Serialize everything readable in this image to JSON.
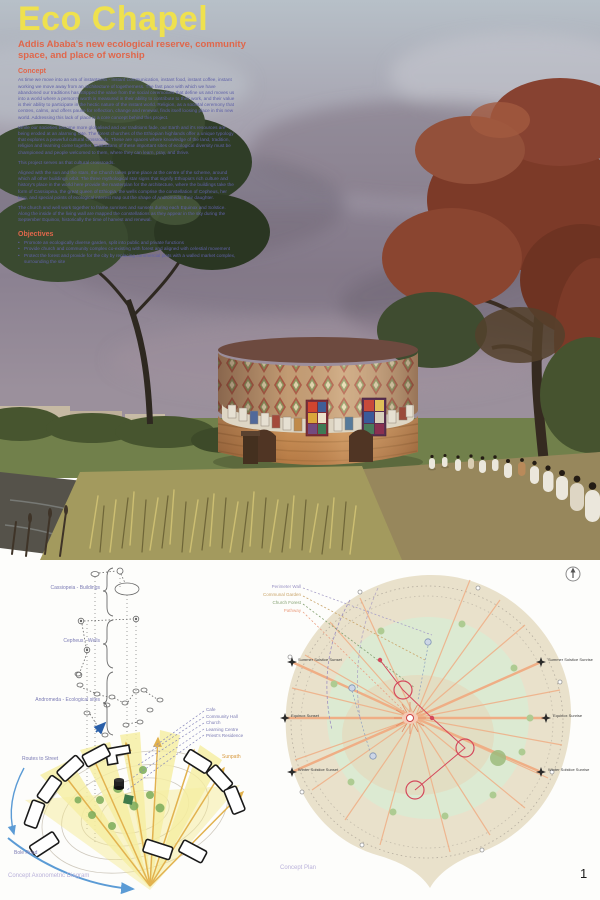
{
  "header": {
    "title": "Eco Chapel",
    "subtitle_lines": [
      "Addis Ababa's new ecological reserve, community",
      "space, and place of worship"
    ]
  },
  "concept": {
    "heading": "Concept",
    "paragraphs": [
      "As time we move into an era of instantness - instant communication, instant food, instant coffee, instant working we move away from an architecture of togetherness. The fast pace with which we have abandoned our traditions has stripped the value from the social ceremonies that define us and moves us into a world where a person's worth is measured in their ability to contribute to their work, and their value is their ability to participate in the hectic nature of the instant world. Religion, as a societal ceremony that centres, calms, and offers pause for reflection, change and renewal, finds itself loosing place in this new world. Addressing this lack of place is a core concept behind this project.",
      "While our societies become more globalised and our traditions fade, our Earth and it's resources are being eroded at an alarming rate. The forest churches of the Ethiopian highlands offer a unique typology that explores a powerful cultural crossroads. These are spaces where knowledge of the land, tradition, religion and learning come together. Custodians of these important sites of ecological diversity must be championed and people welcomed to them, where they can learn, pray, and thrive.",
      "This project serves as that cultural crossroads.",
      "Aligned with the sun and the stars, the Church takes prime place at the centre of the scheme, around which all other buildings orbit. The three mythological star signs that signify Ethiopia's rich culture and history's place in the world here provide the masterplan for the architecture, where the buildings take the form of Cassiopeia, the great queen of Ethiopia, the wells comprise the constellation of Cepheus, her king, and special points of ecological interest map out the shape of Andromeda, their daughter.",
      "The church and well work together to frame sunrises and sunsets during each Equinox and Solstice. Along the inside of the living wall are mapped the constellations as they appear in the sky during the September Equinox, historically the time of harvest and renewal."
    ]
  },
  "objectives": {
    "heading": "Objectives",
    "items": [
      "Promote an ecologically diverse garden, split into public and private functions",
      "Provide church and community complex co-existing with forest and aligned with celestial movement",
      "Protect the forest and provide for the city by replacing commercial plots with a walled market complex, surrounding the site"
    ]
  },
  "axon": {
    "caption": "Concept Axonometric Diagram",
    "group_labels": [
      "Cassiopeia - Buildings",
      "Cepheus - Wells",
      "Andromeda - Ecological sites"
    ],
    "route_label": "Routes to Street",
    "road_label": "Bole Road",
    "sunpath_label": "Sunpath",
    "building_labels": [
      "Cafe",
      "Community Hall",
      "Church",
      "Learning Centre",
      "Priest's Residence"
    ]
  },
  "plan": {
    "caption": "Concept Plan",
    "legend": [
      "Perimeter Wall",
      "Communal Garden",
      "Church Forest",
      "Pathway"
    ],
    "markers_left": [
      "Summer Solstice Sunset",
      "Equinox Sunset",
      "Winter Solstice Sunset"
    ],
    "markers_right": [
      "Summer Solstice Sunrise",
      "Equinox Sunrise",
      "Winter Solstice Sunrise"
    ]
  },
  "page_number": "1",
  "colors": {
    "title_yellow": "#efe14e",
    "accent_orange": "#e0674b",
    "body_purple": "#5f61a8",
    "diagram_purple": "#7b7bb4",
    "sun_orange": "#e2b24e",
    "route_blue": "#5b9bd5",
    "plan_salmon": "#efae85",
    "plan_red": "#d4495c",
    "forest_green": "#dcead2"
  }
}
